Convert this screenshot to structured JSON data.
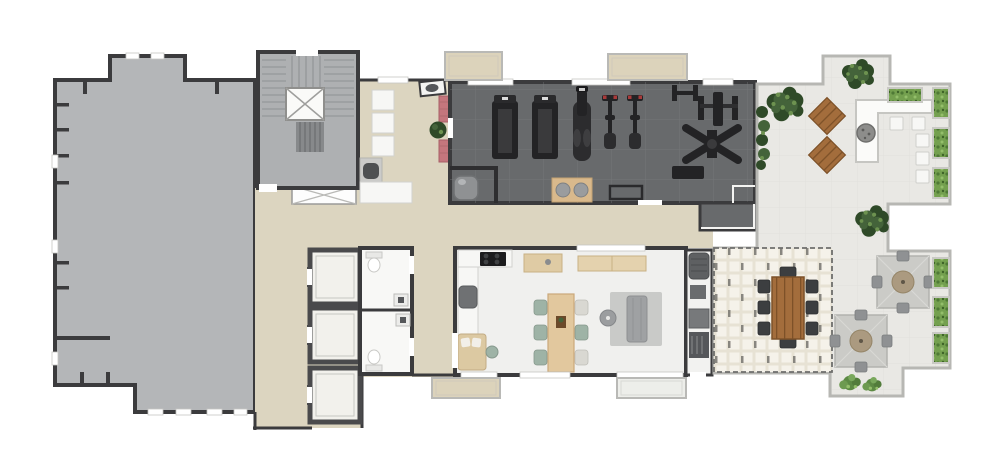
{
  "meta": {
    "kind": "architectural-floor-plan",
    "style": "top-down 3D rendered plan, no text labels",
    "canvas": {
      "width": 1000,
      "height": 464
    }
  },
  "palette": {
    "wall": "#3b3b3d",
    "slab": "#b4b6b8",
    "stair_floor": "#aeb0b2",
    "tread": "#8f9294",
    "corridor": "#dcd5c0",
    "gym_floor": "#686a6c",
    "gym_line": "#797b7e",
    "equip": "#232325",
    "red_mat": "#c4767d",
    "terrace": "#e9e8e4",
    "terrace_edge": "#b7b7b3",
    "pergola": "#e7e2d4",
    "pergola_cell": "#f5f2ea",
    "wood": "#a36d3c",
    "wood_dark": "#7d5128",
    "green_dark": "#2f4a28",
    "green_mid": "#44633a",
    "green_light": "#6d9250",
    "hedge": "#74a04f",
    "planter": "#c9c9c4",
    "white_obj": "#f7f7f5",
    "rug": "#c9cac8",
    "sofa": "#9fa1a3",
    "tan_table": "#e2c89e",
    "chair_green": "#9eb3a6",
    "balcony_tan": "#dcd3bb",
    "bath_floor": "#f8f8f6",
    "elevator_inner": "#f2f1ec",
    "party_floor": "#f0f0ee",
    "umbrella": "#cbcbc7",
    "firepit": "#8d8d8b",
    "red_accent": "#a83a3a"
  },
  "rooms": [
    {
      "id": "open-slab-area",
      "desc": "large open gray-floor area with notched perimeter walls",
      "position": "left"
    },
    {
      "id": "stair-core",
      "desc": "staircase wrapping a central crossed void, door at top",
      "position": "upper-center-left"
    },
    {
      "id": "fitness-lounge",
      "desc": "lounge outside gym: three white seats, cabinet, pouf, counter, wall sink",
      "position": "center"
    },
    {
      "id": "fitness-room",
      "desc": "gym with dark tiled floor",
      "equipment": [
        "treadmill",
        "treadmill",
        "elliptical-trainer",
        "spin-bike",
        "spin-bike",
        "h-bench",
        "barbell-bench-rack",
        "cable-cross-machine",
        "low-bench",
        "open-bench-outline",
        "exercise-mat-with-two-balls",
        "water-cooler-nook",
        "wall-mat-red",
        "wall-mat-red",
        "planter-pot"
      ]
    },
    {
      "id": "circulation",
      "desc": "beige corridors and lobby linking all rooms, hatched floor void below stairs"
    },
    {
      "id": "elevator-bank",
      "desc": "three elevator cabins with left-side doors",
      "count": 3
    },
    {
      "id": "restrooms",
      "desc": "two WCs, each with toilet and washbasin",
      "count": 2
    },
    {
      "id": "party-room",
      "desc": "gourmet/party room: kitchen counter with cooktop, two sideboards, dining table with six chairs, daybed, armchair, rug with sofa and round coffee table"
    },
    {
      "id": "grill-station",
      "desc": "barbecue counter strip with four dark appliances",
      "position": "east-of-party-room"
    },
    {
      "id": "upper-terrace",
      "desc": "paved terrace: L-shaped counter with fire pit, five white stools, two rotated wood deck pads, trees, hedge planters"
    },
    {
      "id": "pergola-dining",
      "desc": "pergola-covered patio with long wood table and eight dark chairs"
    },
    {
      "id": "umbrella-terrace",
      "desc": "patio with two square umbrellas over round tables, four chairs each, hedge planters, shrubs"
    },
    {
      "id": "balconies",
      "desc": "small balcony bays on the north and south facades",
      "count": 4
    }
  ]
}
